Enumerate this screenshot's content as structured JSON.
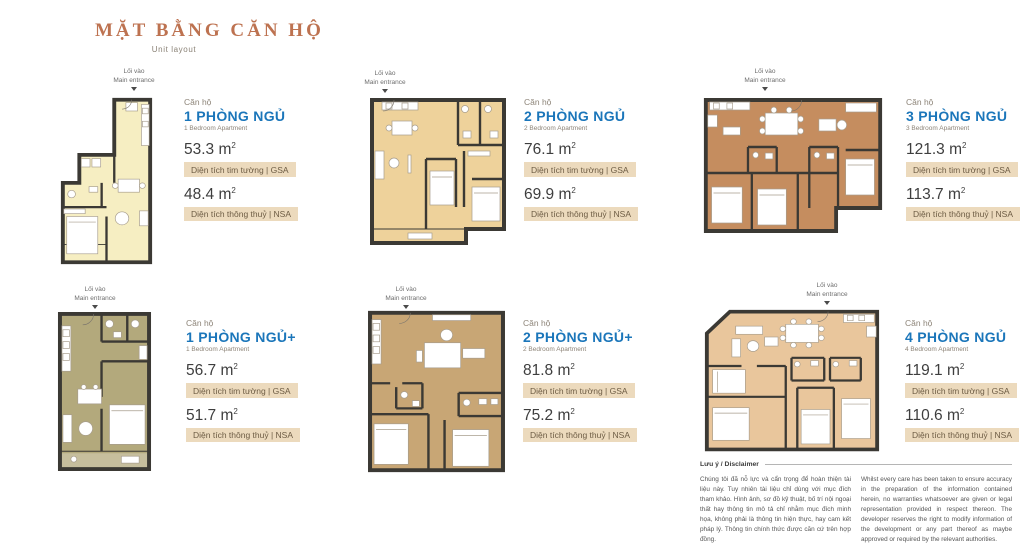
{
  "page": {
    "title": "MẶT BẰNG CĂN HỘ",
    "subtitle": "Unit layout"
  },
  "labels": {
    "unit_label": "Căn hộ",
    "entrance_vn": "Lối vào",
    "entrance_en": "Main entrance",
    "gsa_label": "Diện tích tim tường | GSA",
    "nsa_label": "Diện tích thông thuỷ | NSA",
    "sqm_base": "m",
    "sqm_sup": "2"
  },
  "colors": {
    "accent_blue": "#1b76ba",
    "heading_copper": "#bd7250",
    "area_strip_bg": "#ecdabd",
    "wall": "#3b3934"
  },
  "units": [
    {
      "title_vn": "1 PHÒNG NGỦ",
      "title_en": "1 Bedroom Apartment",
      "gsa": "53.3",
      "nsa": "48.4",
      "plan_color": "#f6eec2"
    },
    {
      "title_vn": "2 PHÒNG NGỦ",
      "title_en": "2 Bedroom Apartment",
      "gsa": "76.1",
      "nsa": "69.9",
      "plan_color": "#eed29b"
    },
    {
      "title_vn": "3 PHÒNG NGỦ",
      "title_en": "3 Bedroom Apartment",
      "gsa": "121.3",
      "nsa": "113.7",
      "plan_color": "#c58d5f"
    },
    {
      "title_vn": "1 PHÒNG NGỦ+",
      "title_en": "1 Bedroom Apartment",
      "gsa": "56.7",
      "nsa": "51.7",
      "plan_color": "#b3a97c"
    },
    {
      "title_vn": "2 PHÒNG NGỦ+",
      "title_en": "2 Bedroom Apartment",
      "gsa": "81.8",
      "nsa": "75.2",
      "plan_color": "#c8a675"
    },
    {
      "title_vn": "4 PHÒNG NGỦ",
      "title_en": "4 Bedroom Apartment",
      "gsa": "119.1",
      "nsa": "110.6",
      "plan_color": "#e9c69c"
    }
  ],
  "disclaimer": {
    "heading": "Lưu ý / Disclaimer",
    "vietnamese": "Chúng tôi đã nỗ lực và cẩn trọng để hoàn thiện tài liệu này. Tuy nhiên tài liệu chỉ dùng với mục đích tham khảo. Hình ảnh, sơ đồ kỹ thuật, bố trí nội ngoại thất hay thông tin mô tả chỉ nhằm mục đích minh họa, không phải là thông tin hiện thực, hay cam kết pháp lý. Thông tin chính thức được căn cứ trên hợp đồng.",
    "english": "Whilst every care has been taken to ensure accuracy in the preparation of the information contained herein, no warranties whatsoever are given or legal representation provided in respect thereon. The developer reserves the right to modify information of the development or any part thereof as maybe approved or required by the relevant authorities."
  }
}
